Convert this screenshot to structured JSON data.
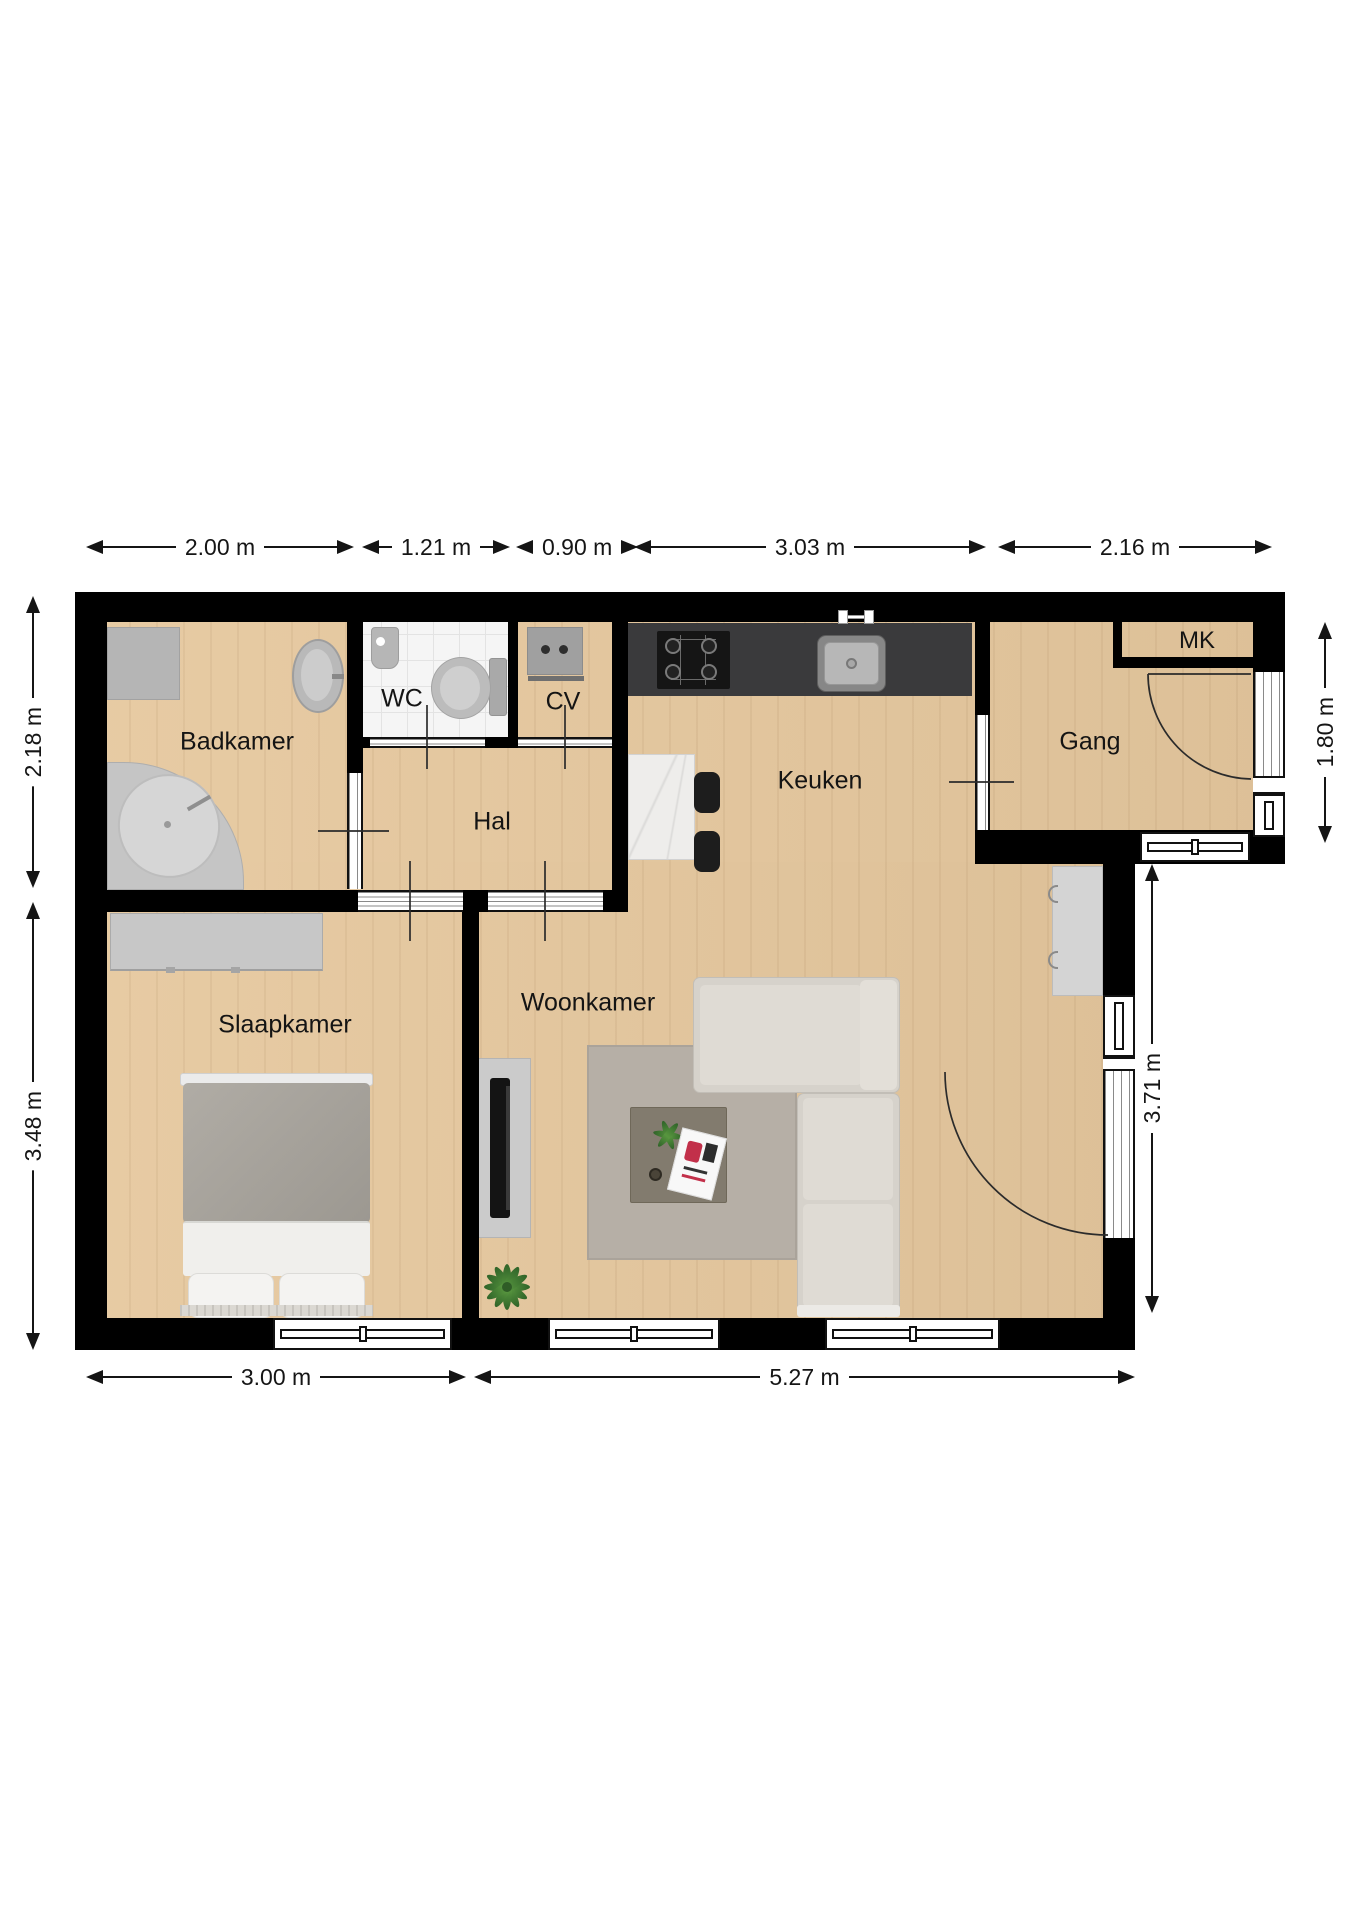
{
  "rooms": {
    "badkamer": "Badkamer",
    "wc": "WC",
    "cv": "CV",
    "hal": "Hal",
    "keuken": "Keuken",
    "gang": "Gang",
    "mk": "MK",
    "slaapkamer": "Slaapkamer",
    "woonkamer": "Woonkamer"
  },
  "dimensions": {
    "top": [
      "2.00 m",
      "1.21 m",
      "0.90 m",
      "3.03 m",
      "2.16 m"
    ],
    "bottom": [
      "3.00 m",
      "5.27 m"
    ],
    "left": [
      "2.18 m",
      "3.48 m"
    ],
    "right": [
      "1.80 m",
      "3.71 m"
    ]
  },
  "colors": {
    "wall": "#000000",
    "wood_floor": "#e6c89e",
    "tile_floor": "#f5f5f5",
    "kitchen_counter": "#3a3a3c",
    "sofa": "#d6d2cb",
    "rug": "#b6afa6",
    "dimension_text": "#151515"
  }
}
